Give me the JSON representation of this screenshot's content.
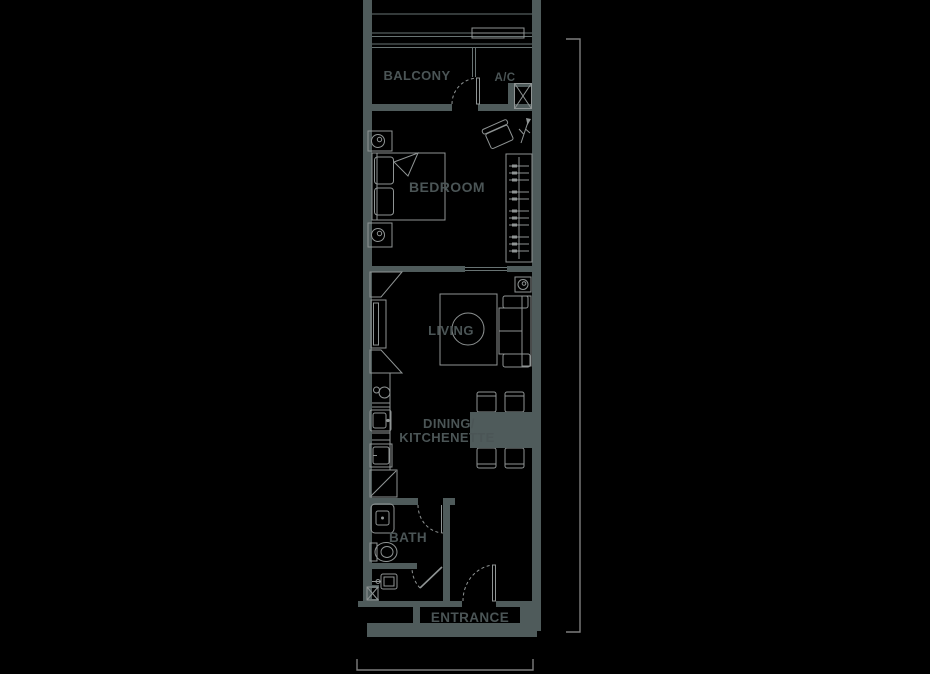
{
  "colors": {
    "background": "#000000",
    "wall": "#4f5b5b",
    "furniture_line": "#8f9494",
    "structure_line": "#687373",
    "label_text": "#4b5556",
    "dimension_line": "#7d7d7d"
  },
  "labels": {
    "balcony": "BALCONY",
    "ac": "A/C",
    "bedroom": "BEDROOM",
    "living": "LIVING",
    "dining_line1": "DINING/",
    "dining_line2": "KITCHENETTE",
    "bath": "BATH",
    "entrance": "ENTRANCE"
  }
}
